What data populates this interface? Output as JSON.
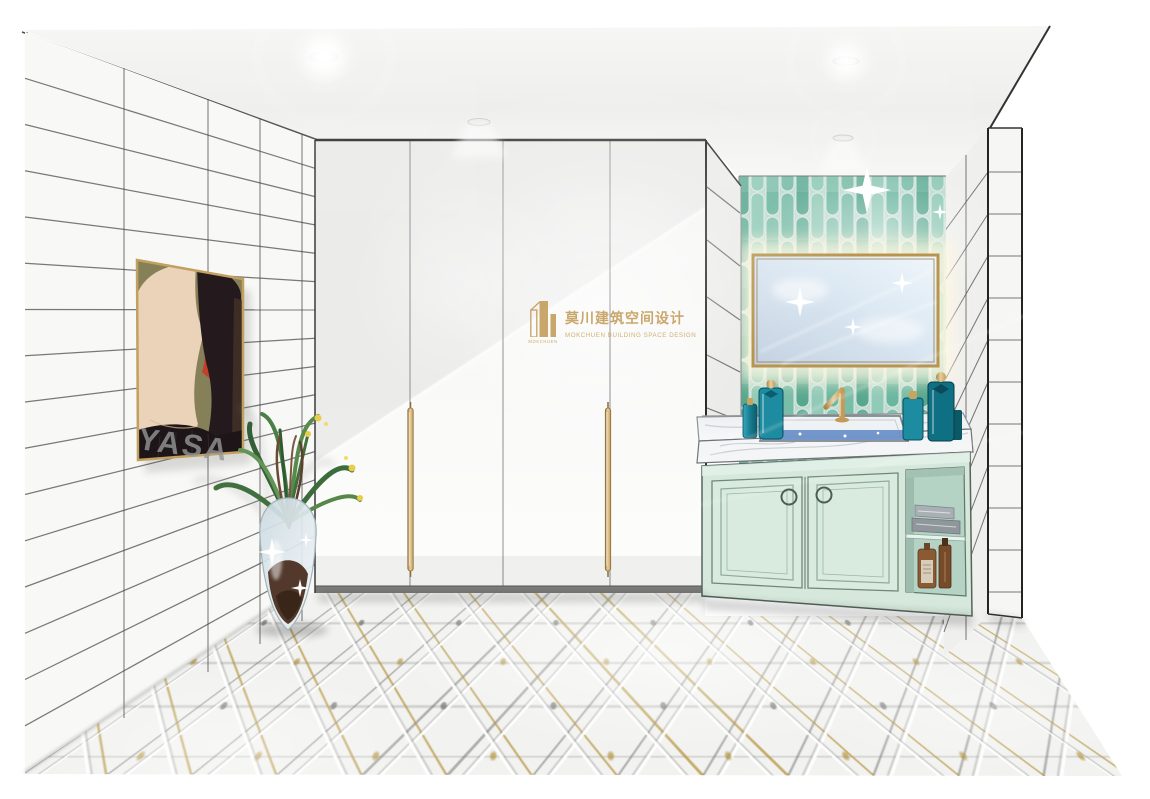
{
  "meta": {
    "type": "interior-design-rendering",
    "room": "bathroom-vanity-and-wardrobe-elevation"
  },
  "watermarks": {
    "brand": {
      "icon": "mokchuen-building-logo-icon",
      "icon_caption": "MOKCHUEN",
      "title_zh": "莫川建筑空间设计",
      "subtitle_en": "MOKCHUEN BUILDING SPACE DESIGN",
      "color": "#c39c58"
    },
    "artwork": {
      "text": "YASA",
      "color": "#969696"
    }
  },
  "palette": {
    "ink_line": "#3f3f3f",
    "backsplash_green": "#7fc3ac",
    "backsplash_green_dark": "#5fae97",
    "cabinet_mint": "#d6e8dc",
    "brass_gold": "#c7a35b",
    "marble": "#f0f2f4",
    "water_blue": "#5d87c3",
    "towel_gray_dark": "#8f979c",
    "towel_gray_light": "#a9b0b5",
    "bottle_teal": "#1d8ba0",
    "bottle_teal_dark": "#0f6f83",
    "amber_glass": "#8a5a33",
    "amber_glass_dark": "#774b2a",
    "artwork_olive": "#868059",
    "artwork_skin": "#ead3b8",
    "artwork_hair": "#241a1e",
    "artwork_red": "#c23f28",
    "leaf_green": "#4c7f45",
    "floor_gold_line": "#b08e30"
  },
  "scene_objects": [
    "ceiling-downlights",
    "left-tiled-wall",
    "abstract-portrait-artwork",
    "glass-floor-vase-with-plant",
    "white-wardrobe-four-doors",
    "gold-bar-handles",
    "open-side-shelving",
    "green-picket-tile-backsplash",
    "backlit-gold-frame-mirror",
    "gold-faucet",
    "marble-countertop-with-sink",
    "teal-perfume-bottles",
    "mint-green-vanity-cabinet",
    "ring-pull-knobs",
    "open-shelf-with-towels",
    "amber-apothecary-bottles",
    "square-tiled-column",
    "patterned-tile-floor"
  ]
}
